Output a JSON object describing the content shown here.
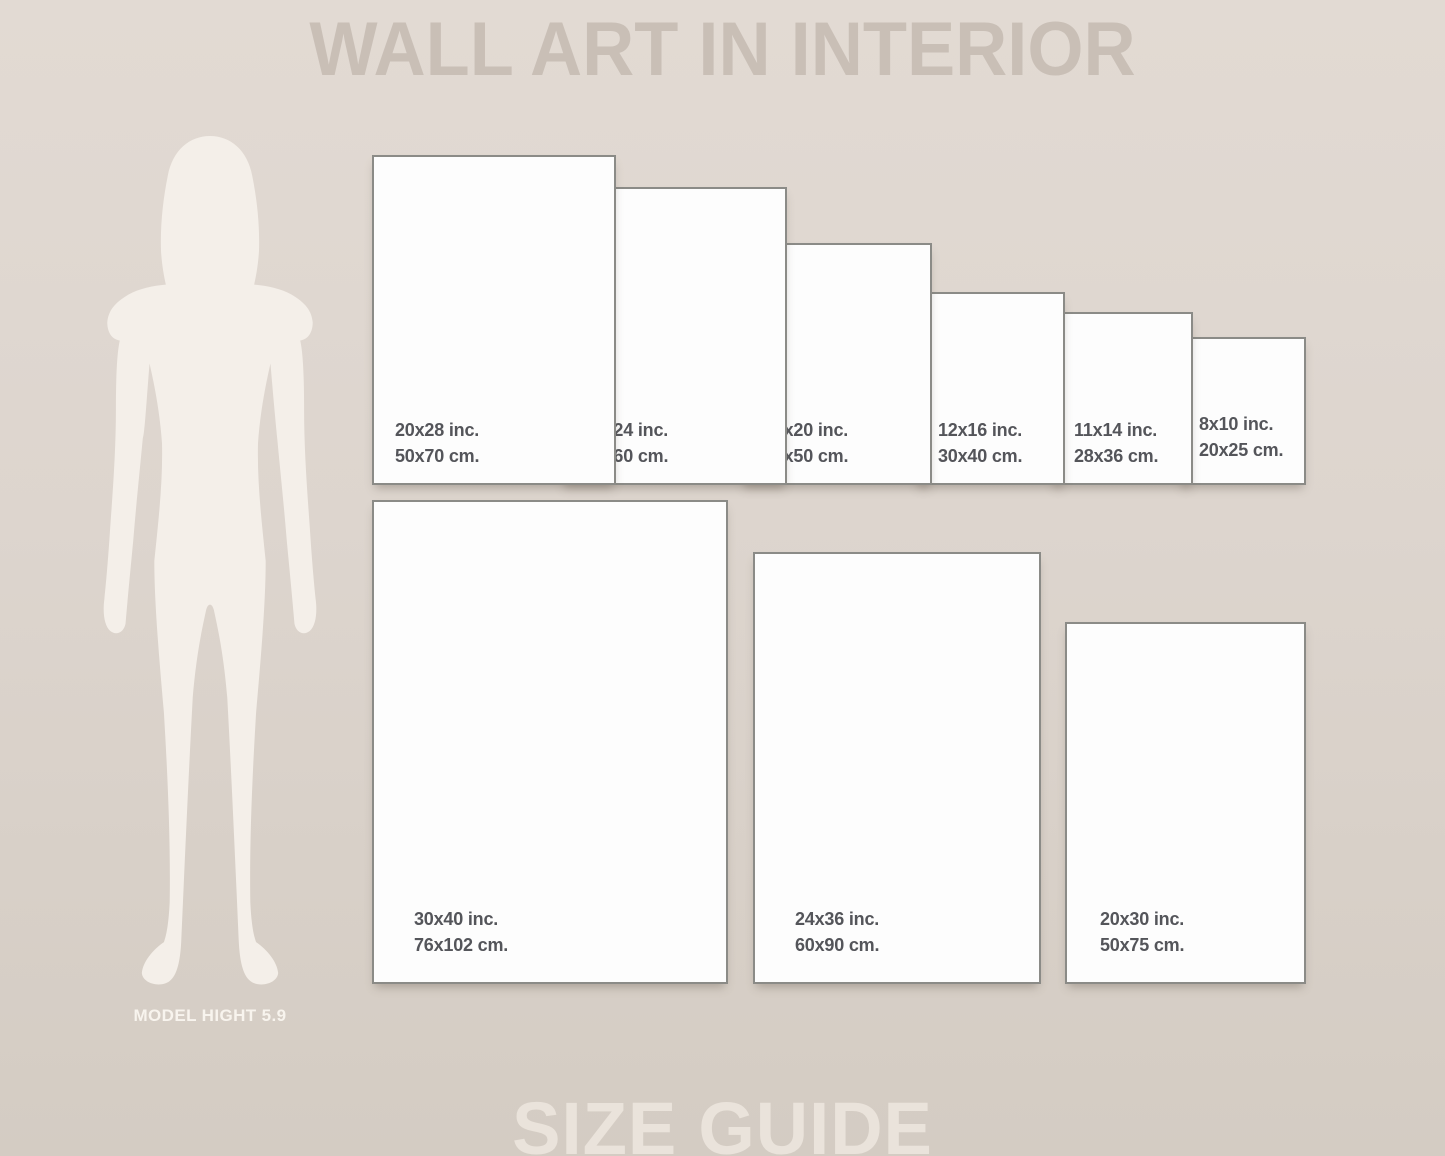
{
  "title": "WALL ART IN INTERIOR",
  "footer_title": "SIZE GUIDE",
  "model": {
    "label": "MODEL HIGHT 5.9"
  },
  "frames": {
    "top_row": [
      {
        "inches": "20x28 inc.",
        "cm": "50x70 cm."
      },
      {
        "inches": "18x24 inc.",
        "cm": "45x60 cm."
      },
      {
        "inches": "16x20 inc.",
        "cm": "40x50 cm."
      },
      {
        "inches": "12x16 inc.",
        "cm": "30x40 cm."
      },
      {
        "inches": "11x14 inc.",
        "cm": "28x36 cm."
      },
      {
        "inches": "8x10 inc.",
        "cm": "20x25 cm."
      }
    ],
    "bottom_row": [
      {
        "inches": "30x40 inc.",
        "cm": "76x102 cm."
      },
      {
        "inches": "24x36 inc.",
        "cm": "60x90 cm."
      },
      {
        "inches": "20x30 inc.",
        "cm": "50x75 cm."
      }
    ]
  },
  "colors": {
    "background_top": "#e2dad3",
    "background_bottom": "#d4ccc3",
    "title_color": "#c9bfb6",
    "footer_color": "#eae3db",
    "frame_fill": "#fdfdfd",
    "frame_border": "#8b8b87",
    "label_color": "#54555a",
    "silhouette_color": "#f4efe9",
    "model_label_color": "#f8f4ee"
  }
}
